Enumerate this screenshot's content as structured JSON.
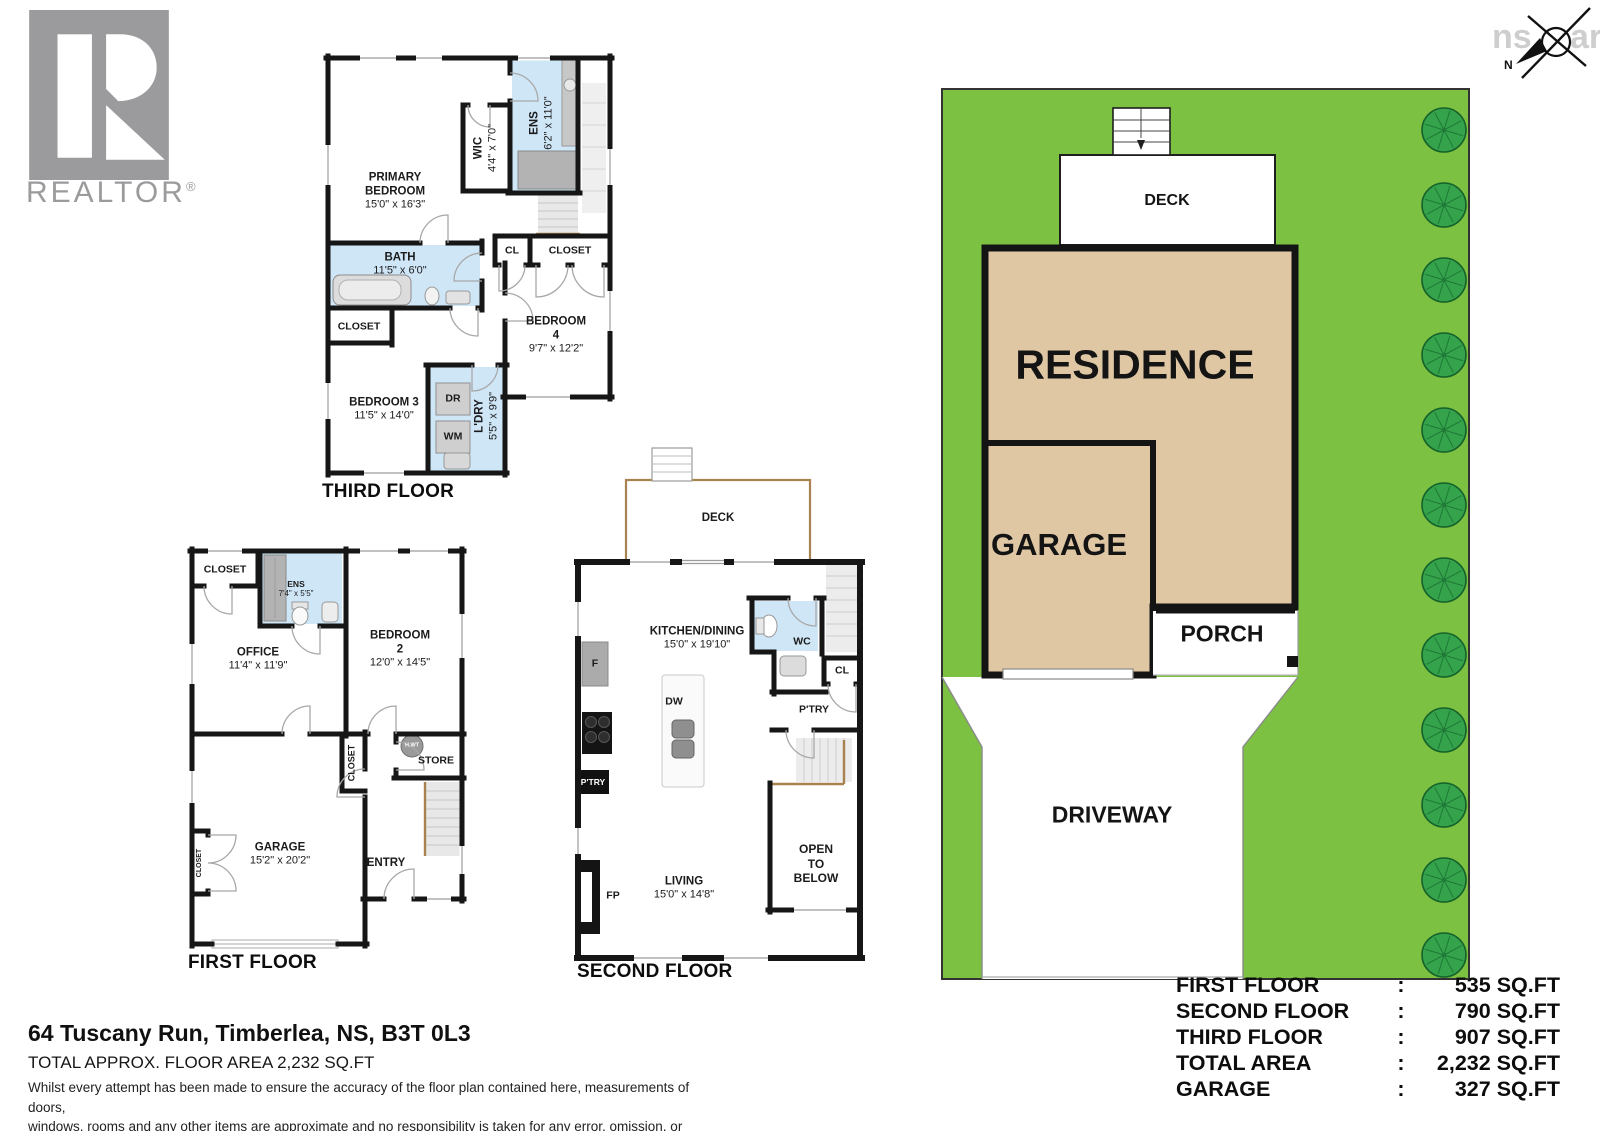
{
  "branding": {
    "logo_text": "REALTOR",
    "registered": "®"
  },
  "compass": {
    "north": "N",
    "watermark_left": "ns",
    "watermark_right": "ar"
  },
  "third_floor": {
    "title": "THIRD FLOOR",
    "primary": {
      "name": "PRIMARY BEDROOM",
      "dims": "15'0\" x 16'3\""
    },
    "wic": {
      "name": "WIC",
      "dims": "4'4\" x 7'0\""
    },
    "ens": {
      "name": "ENS",
      "dims": "6'2\" x 11'0\""
    },
    "bath": {
      "name": "BATH",
      "dims": "11'5\" x 6'0\""
    },
    "cl": "CL",
    "closet_hall": "CLOSET",
    "bedroom4": {
      "name": "BEDROOM 4",
      "dims": "9'7\" x 12'2\""
    },
    "closet_small": "CLOSET",
    "bedroom3": {
      "name": "BEDROOM 3",
      "dims": "11'5\" x 14'0\""
    },
    "dryer": "DR",
    "washer": "WM",
    "laundry": {
      "name": "L'DRY",
      "dims": "5'5\" x 9'9\""
    }
  },
  "first_floor": {
    "title": "FIRST FLOOR",
    "closet_top": "CLOSET",
    "ens": {
      "name": "ENS",
      "dims": "7'4\" x 5'5\""
    },
    "office": {
      "name": "OFFICE",
      "dims": "11'4\" x 11'9\""
    },
    "bedroom2": {
      "name": "BEDROOM 2",
      "dims": "12'0\" x 14'5\""
    },
    "closet_mid": "CLOSET",
    "store": "STORE",
    "hwt": "H.WT",
    "garage": {
      "name": "GARAGE",
      "dims": "15'2\" x 20'2\""
    },
    "entry": "ENTRY",
    "closet_left": "CLOSET"
  },
  "second_floor": {
    "title": "SECOND FLOOR",
    "deck": "DECK",
    "kitchen": {
      "name": "KITCHEN/DINING",
      "dims": "15'0\" x 19'10\""
    },
    "wc": "WC",
    "cl": "CL",
    "pantry_right": "P'TRY",
    "fridge": "F",
    "dishwasher": "DW",
    "pantry_left": "P'TRY",
    "living": {
      "name": "LIVING",
      "dims": "15'0\" x 14'8\""
    },
    "fireplace": "FP",
    "open_line1": "OPEN TO",
    "open_line2": "BELOW"
  },
  "site_plan": {
    "deck": "DECK",
    "residence": "RESIDENCE",
    "garage": "GARAGE",
    "porch": "PORCH",
    "driveway": "DRIVEWAY"
  },
  "footer": {
    "address": "64 Tuscany Run, Timberlea, NS, B3T 0L3",
    "total_area": "TOTAL APPROX. FLOOR AREA 2,232 SQ.FT",
    "disclaimer_line1": "Whilst every attempt has been made to ensure the accuracy of the floor plan contained here, measurements of doors,",
    "disclaimer_line2": "windows, rooms and any other items are approximate and no responsibility is taken for any error, omission, or misstatement.",
    "disclaimer_line3": "This plan is for illustrative purposes only and should be used as such by any prospective purchaser."
  },
  "area_table": {
    "colon": ":",
    "rows": [
      {
        "label": "FIRST FLOOR",
        "value": "535 SQ.FT"
      },
      {
        "label": "SECOND FLOOR",
        "value": "790 SQ.FT"
      },
      {
        "label": "THIRD FLOOR",
        "value": "907 SQ.FT"
      },
      {
        "label": "TOTAL AREA",
        "value": "2,232 SQ.FT"
      },
      {
        "label": "GARAGE",
        "value": "327 SQ.FT"
      }
    ]
  },
  "colors": {
    "lawn": "#7cc142",
    "tree": "#35a24c",
    "residence_fill": "#dfc7a4",
    "wet_room": "#cfe6f7",
    "wall": "#161616",
    "logo_gray": "#9b9b9d",
    "rail_brown": "#a9834f"
  }
}
